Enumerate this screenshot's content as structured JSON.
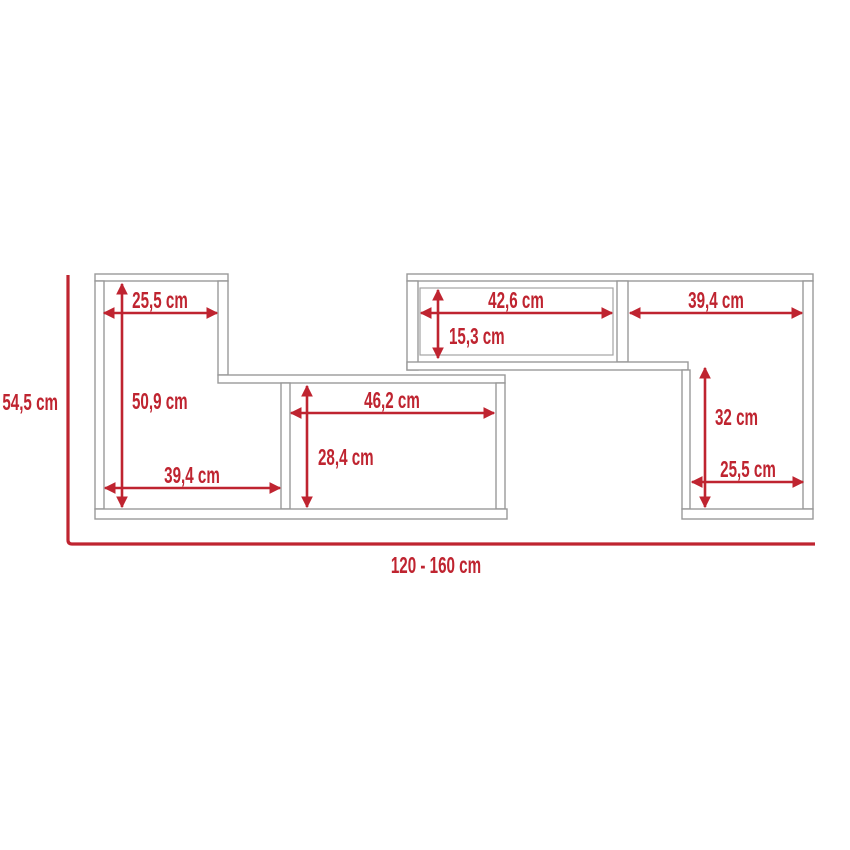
{
  "diagram": {
    "type": "furniture-dimension-drawing",
    "colors": {
      "dimension_red": "#bf2430",
      "outline_gray": "#999999"
    },
    "labels": {
      "overall_height": "54,5 cm",
      "overall_width": "120 - 160 cm",
      "top_left_width": "25,5 cm",
      "left_interior_height": "50,9 cm",
      "bottom_left_width": "39,4 cm",
      "center_width": "46,2 cm",
      "center_height": "28,4 cm",
      "top_center_width": "42,6 cm",
      "top_center_height": "15,3 cm",
      "top_right_width": "39,4 cm",
      "right_height": "32 cm",
      "bottom_right_width": "25,5 cm"
    }
  }
}
